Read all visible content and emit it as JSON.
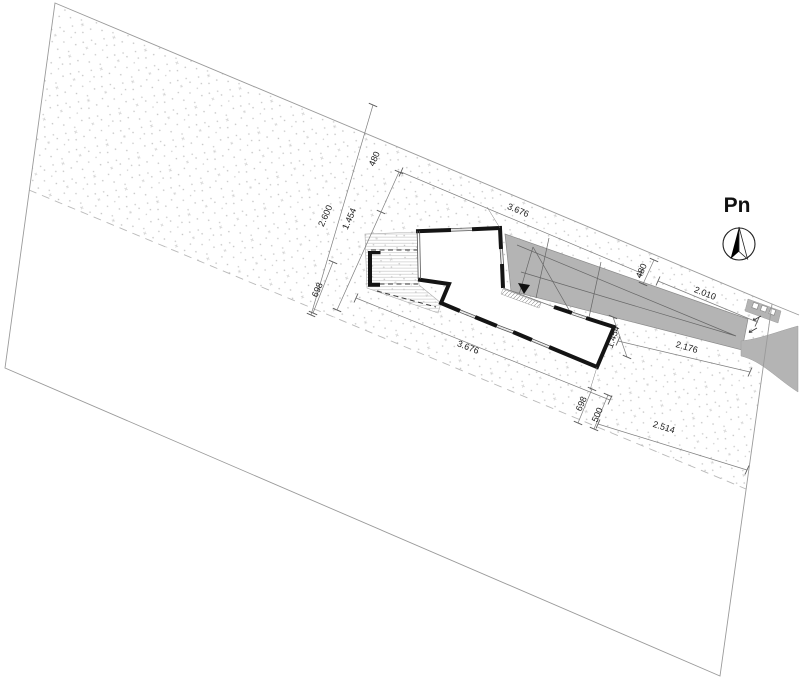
{
  "plan": {
    "type": "architectural site plan",
    "compass": {
      "label": "Pn"
    },
    "dims": {
      "top_width": "3.676",
      "bottom_width": "3.676",
      "left_total": "2.600",
      "left_part": "1.454",
      "left_offset": "480",
      "left_gap": "698",
      "corner_offset_a": "698",
      "corner_offset_b": "500",
      "bottom_right_width": "2.514",
      "drive_offset": "480",
      "drive_top_width": "2.010",
      "drive_cross": "1.454",
      "drive_bottom_width": "2.176"
    },
    "colors": {
      "driveway_gray": "#b4b4b4",
      "wall_black": "#141414",
      "boundary_gray": "#9a9a9a",
      "dimension_gray": "#7d7d7d"
    }
  }
}
